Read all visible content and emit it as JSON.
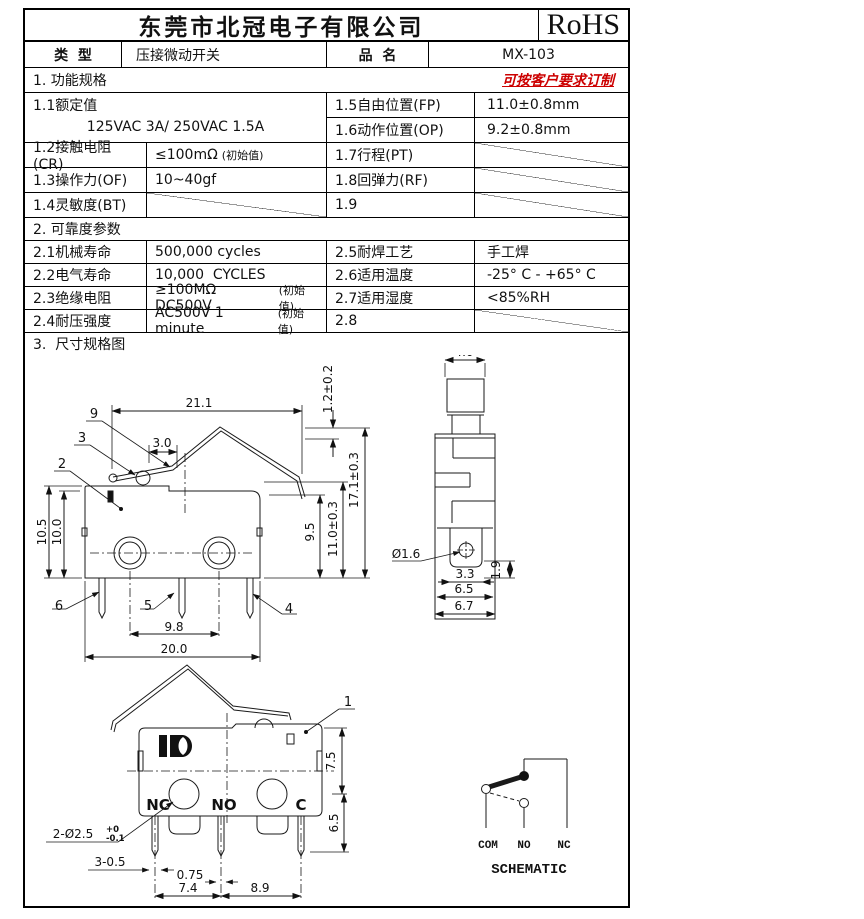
{
  "header": {
    "company": "东莞市北冠电子有限公司",
    "cert": "RoHS"
  },
  "meta": {
    "type_label": "类  型",
    "type_value": "压接微动开关",
    "name_label": "品  名",
    "name_value": "MX-103"
  },
  "spec1": {
    "title": "1. 功能规格",
    "note": "可按客户要求订制",
    "r11_label": "1.1额定值",
    "r11_value": "125VAC 3A/ 250VAC 1.5A",
    "r15_label": "1.5自由位置(FP)",
    "r15_value": "11.0±0.8mm",
    "r16_label": "1.6动作位置(OP)",
    "r16_value": "9.2±0.8mm",
    "r12_label": "1.2接触电阻(CR)",
    "r12_value": "≤100mΩ",
    "r12_note": "(初始值)",
    "r17_label": "1.7行程(PT)",
    "r13_label": "1.3操作力(OF)",
    "r13_value": "10~40gf",
    "r18_label": "1.8回弹力(RF)",
    "r14_label": "1.4灵敏度(BT)",
    "r19_label": "1.9"
  },
  "spec2": {
    "title": "2. 可靠度参数",
    "r21_label": "2.1机械寿命",
    "r21_value": "500,000 cycles",
    "r25_label": "2.5耐焊工艺",
    "r25_value": "手工焊",
    "r22_label": "2.2电气寿命",
    "r22_value": "10,000  CYCLES",
    "r26_label": "2.6适用温度",
    "r26_value": "-25° C - +65° C",
    "r23_label": "2.3绝缘电阻",
    "r23_value": "≥100MΩ  DC500V",
    "r23_note": "(初始值)",
    "r27_label": "2.7适用湿度",
    "r27_value": "<85%RH",
    "r24_label": "2.4耐压强度",
    "r24_value": "AC500V 1 minute",
    "r24_note": "(初始值)",
    "r28_label": "2.8"
  },
  "section3": {
    "title": "3.  尺寸规格图"
  },
  "drawings": {
    "lever_view": {
      "d21_1": "21.1",
      "d1_2": "1.2±0.2",
      "d3_0": "3.0",
      "p9": "9",
      "p3": "3",
      "p2": "2",
      "d10_5": "10.5",
      "d10_0": "10.0",
      "d9_5": "9.5",
      "d11_0": "11.0±0.3",
      "d17_1": "17.1±0.3",
      "p6": "6",
      "p5": "5",
      "p4": "4",
      "d9_8": "9.8",
      "d20_0": "20.0"
    },
    "side_view": {
      "d4_0": "4.0",
      "dhole": "Ø1.6",
      "d3_3": "3.3",
      "d6_5": "6.5",
      "d6_7": "6.7",
      "d1_9": "1.9"
    },
    "front_view": {
      "p1": "1",
      "d7_5": "7.5",
      "d6_5": "6.5",
      "nc": "NC",
      "no": "NO",
      "c": "C",
      "dhole": "2-Ø2.5",
      "tol_up": "+0",
      "tol_dn": "-0.1",
      "d3_05": "3-0.5",
      "d0_75": "0.75",
      "d7_4": "7.4",
      "d8_9": "8.9"
    },
    "schematic": {
      "com": "COM",
      "no": "NO",
      "nc": "NC",
      "title": "SCHEMATIC"
    }
  }
}
